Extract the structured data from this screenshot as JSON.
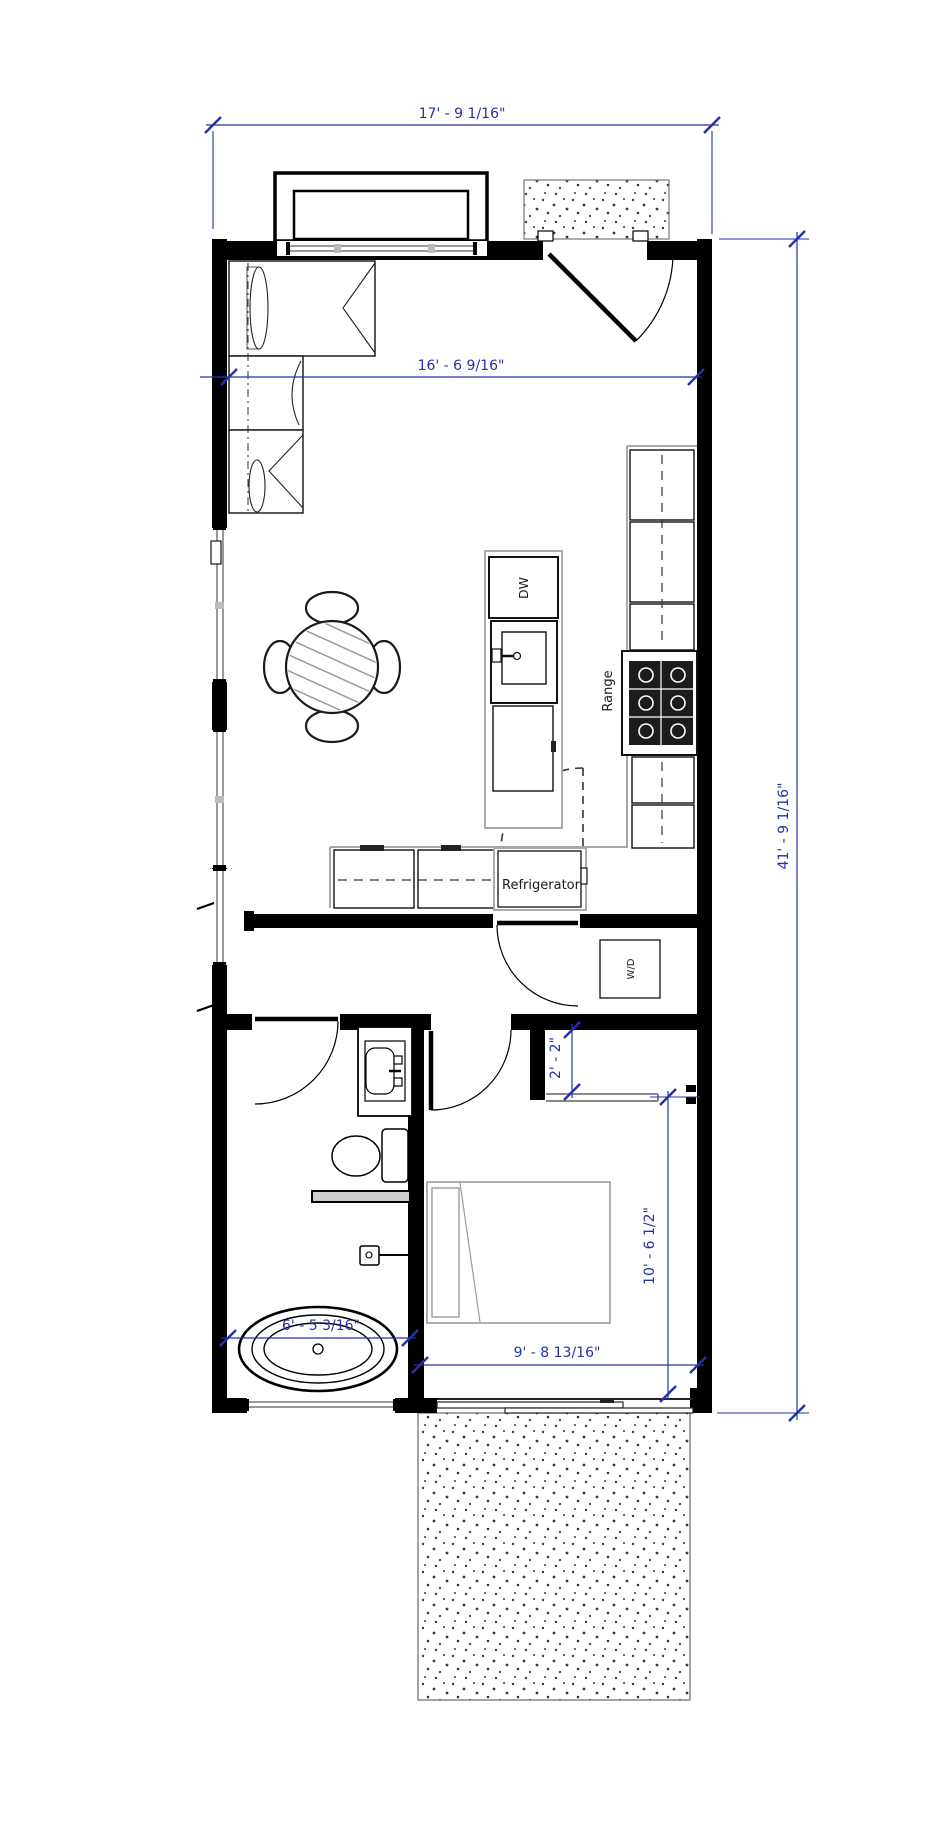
{
  "drawing_type": "floor-plan",
  "colors": {
    "dimension_blue": "#2432A6",
    "wall_black": "#000000",
    "furniture_gray": "#9B9B9B",
    "glass_gray": "#999999"
  },
  "appliance_labels": {
    "dishwasher": "DW",
    "range": "Range",
    "refrigerator": "Refrigerator",
    "washer_dryer": "W/D"
  },
  "dimensions": {
    "overall_width": {
      "text": "17' - 9 1/16\"",
      "orientation": "horizontal",
      "location": "top-exterior"
    },
    "overall_depth": {
      "text": "41' - 9 1/16\"",
      "orientation": "vertical",
      "location": "right-exterior"
    },
    "living_interior_width": {
      "text": "16' - 6 9/16\"",
      "orientation": "horizontal",
      "location": "living-room"
    },
    "closet_nook_depth": {
      "text": "2' - 2\"",
      "orientation": "vertical",
      "location": "bedroom-closet"
    },
    "bedroom_depth": {
      "text": "10' - 6 1/2\"",
      "orientation": "vertical",
      "location": "bedroom"
    },
    "bedroom_width": {
      "text": "9' - 8 13/16\"",
      "orientation": "horizontal",
      "location": "bedroom"
    },
    "bathroom_width": {
      "text": "6' - 5 3/16\"",
      "orientation": "horizontal",
      "location": "bathroom-tub"
    }
  }
}
